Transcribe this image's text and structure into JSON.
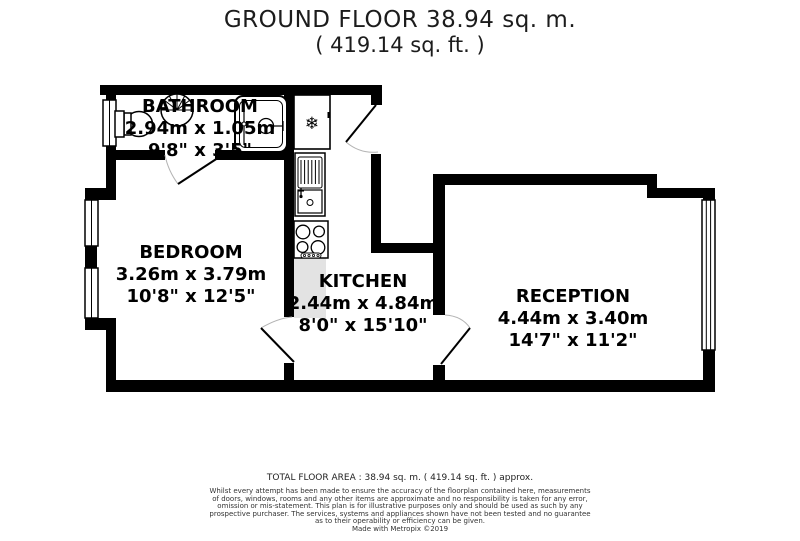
{
  "title": {
    "line1": "GROUND FLOOR 38.94 sq. m.",
    "line2": "( 419.14 sq. ft. )"
  },
  "rooms": [
    {
      "name": "BATHROOM",
      "metric": "2.94m x 1.05m",
      "imperial": "9'8\" x 3'5\""
    },
    {
      "name": "BEDROOM",
      "metric": "3.26m x 3.79m",
      "imperial": "10'8\" x 12'5\""
    },
    {
      "name": "KITCHEN",
      "metric": "2.44m x 4.84m",
      "imperial": "8'0\" x 15'10\""
    },
    {
      "name": "RECEPTION",
      "metric": "4.44m x 3.40m",
      "imperial": "14'7\" x 11'2\""
    }
  ],
  "icons": {
    "freezer_glyph": "❄"
  },
  "colors": {
    "walls": "#000000",
    "counter": "#e3e3e3",
    "door_arc": "#b3b3b3",
    "background": "#ffffff"
  },
  "footer": {
    "total_area": "TOTAL FLOOR AREA : 38.94 sq. m. ( 419.14 sq. ft. ) approx.",
    "disclaimer_lines": [
      "Whilst every attempt has been made to ensure the accuracy of the floorplan contained here, measurements",
      "of doors, windows, rooms and any other items are approximate and no responsibility is taken for any error,",
      "omission or mis-statement. This plan is for illustrative purposes only and should be used as such by any",
      "prospective purchaser. The services, systems and appliances shown have not been tested and no guarantee",
      "as to their operability or efficiency can be given."
    ],
    "credit": "Made with Metropix ©2019"
  }
}
